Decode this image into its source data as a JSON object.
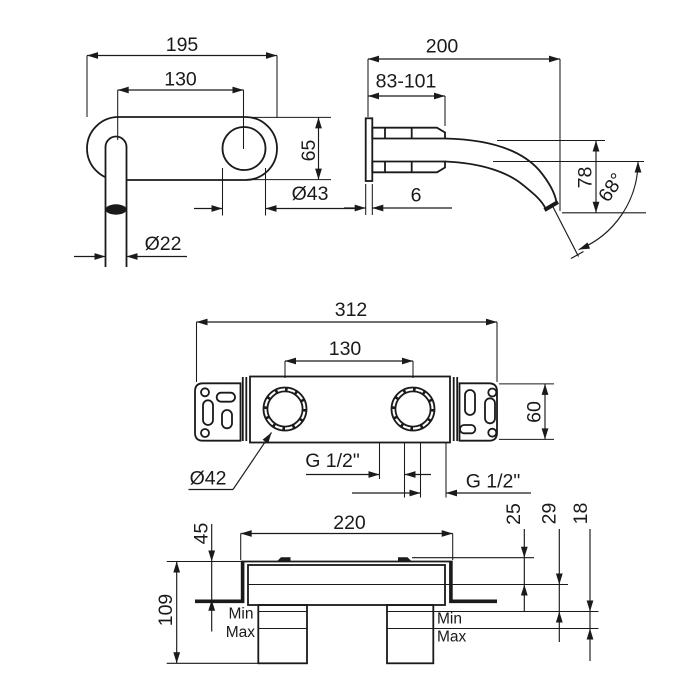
{
  "drawing": {
    "type": "technical-installation-diagram",
    "subject": "wall-mounted basin mixer faucet dimension drawing",
    "colors": {
      "line": "#1a1a1a",
      "background": "#ffffff"
    },
    "views": {
      "spout_front": {
        "width_total": "195",
        "hole_spacing": "130",
        "plate_height": "65",
        "escutcheon_dia": "Ø43",
        "spout_dia": "Ø22"
      },
      "spout_side": {
        "length_total": "200",
        "depth_range": "83-101",
        "plate_thickness": "6",
        "drop_height": "78",
        "outlet_angle": "68°"
      },
      "body_front": {
        "width_total": "312",
        "cartridge_spacing": "130",
        "bracket_height": "60",
        "cartridge_dia": "Ø42",
        "thread_left": "G 1/2\"",
        "thread_right": "G 1/2\""
      },
      "body_side": {
        "body_width": "220",
        "flange_height": "45",
        "total_height": "109",
        "depth_a": "25",
        "depth_b": "29",
        "depth_c": "18",
        "min_left": "Min",
        "max_left": "Max",
        "min_right": "Min",
        "max_right": "Max"
      }
    }
  }
}
